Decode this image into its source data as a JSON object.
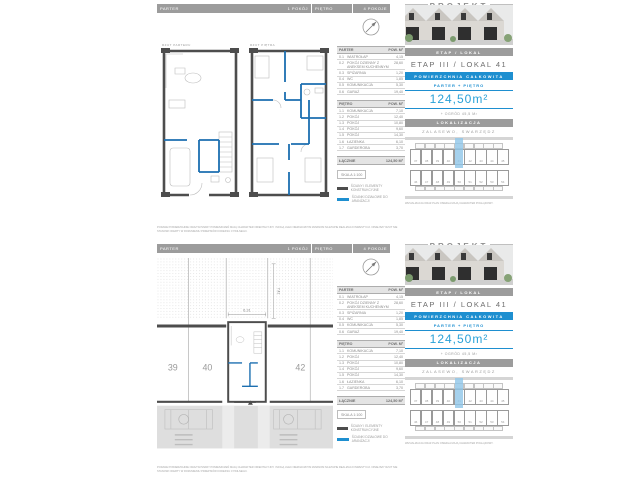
{
  "colors": {
    "accent_blue": "#1e8fd0",
    "area_blue": "#29a1d8",
    "bar_gray": "#9c9c9c",
    "wall_dark": "#4d4d4d",
    "partition_blue": "#1c6fb0",
    "road_gray": "#dcdcdc"
  },
  "sheet": {
    "header": {
      "floor_left": "PARTER",
      "rooms_left": "1 POKÓJ",
      "floor_right": "PIĘTRO",
      "rooms_right": "4 POKOJE"
    },
    "logo": {
      "top": "PROJEKT",
      "bottom": "ZALASEWO"
    },
    "plans": {
      "left_label": "RZUT PARTERU",
      "right_label": "RZUT PIĘTRA"
    },
    "table": {
      "sections": [
        {
          "title": "PARTER",
          "area_header": "POW. M²",
          "rows": [
            {
              "no": "0.1",
              "name": "WIATROŁAP",
              "area": "4,15"
            },
            {
              "no": "0.2",
              "name": "POKÓJ DZIENNY Z ANEKSEM KUCHENNYM",
              "area": "28,60"
            },
            {
              "no": "0.3",
              "name": "SPIŻARNIA",
              "area": "1,20"
            },
            {
              "no": "0.4",
              "name": "WC",
              "area": "1,85"
            },
            {
              "no": "0.5",
              "name": "KOMUNIKACJA",
              "area": "5,30"
            },
            {
              "no": "0.6",
              "name": "GARAŻ",
              "area": "19,40"
            }
          ]
        },
        {
          "title": "PIĘTRO",
          "area_header": "POW. M²",
          "rows": [
            {
              "no": "1.1",
              "name": "KOMUNIKACJA",
              "area": "7,10"
            },
            {
              "no": "1.2",
              "name": "POKÓJ",
              "area": "12,40"
            },
            {
              "no": "1.3",
              "name": "POKÓJ",
              "area": "10,80"
            },
            {
              "no": "1.4",
              "name": "POKÓJ",
              "area": "9,60"
            },
            {
              "no": "1.5",
              "name": "POKÓJ",
              "area": "14,30"
            },
            {
              "no": "1.6",
              "name": "ŁAZIENKA",
              "area": "6,10"
            },
            {
              "no": "1.7",
              "name": "GARDEROBA",
              "area": "3,70"
            }
          ]
        }
      ],
      "total_label": "ŁĄCZNIE",
      "total_area": "124,50 M²",
      "scale": "SKALA 1:100",
      "legend": [
        {
          "label": "ŚCIANY I ELEMENTY KONSTRUKCYJNE"
        },
        {
          "label": "ŚCIANKI DZIAŁOWE DO ARANŻACJI"
        }
      ]
    },
    "info": {
      "etap_lokal_header": "ETAP / LOKAL",
      "etap_lokal": "ETAP III / LOKAL 41",
      "area_header": "POWIERZCHNIA CAŁKOWITA",
      "floors": "PARTER + PIĘTRO",
      "area": "124,50m²",
      "garden": "+ OGRÓD 45,5 M²",
      "location_header": "LOKALIZACJA",
      "location": "ZALASEWO, SWARZĘDZ",
      "minimap": {
        "top_row": [
          "37",
          "38",
          "39",
          "40",
          "41",
          "42",
          "43",
          "44",
          "45"
        ],
        "bottom_row": [
          "46",
          "47",
          "48",
          "49",
          "50",
          "51",
          "52",
          "53",
          "54"
        ],
        "highlighted": "41"
      },
      "fineprint": "WIZUALIZACJA ORAZ PLAN OSIEDLA MAJĄ CHARAKTER POGLĄDOWY."
    },
    "siteplan": {
      "plot_left": "39",
      "plot_mid": "40",
      "plot_right": "42",
      "dim_width": "6,31",
      "dim_depth": "7,42",
      "dim_drive": "5,62"
    },
    "fineprint": "PODANE POWIERZCHNIE ORAZ WYMIARY POMIESZCZEŃ MAJĄ CHARAKTER ORIENTACYJNY I MOGĄ ULEC NIEZNACZNYM ZMIANOM NA ETAPIE REALIZACJI INWESTYCJI. NINIEJSZY RZUT NIE STANOWI OFERTY W ROZUMIENIU PRZEPISÓW KODEKSU CYWILNEGO."
  }
}
